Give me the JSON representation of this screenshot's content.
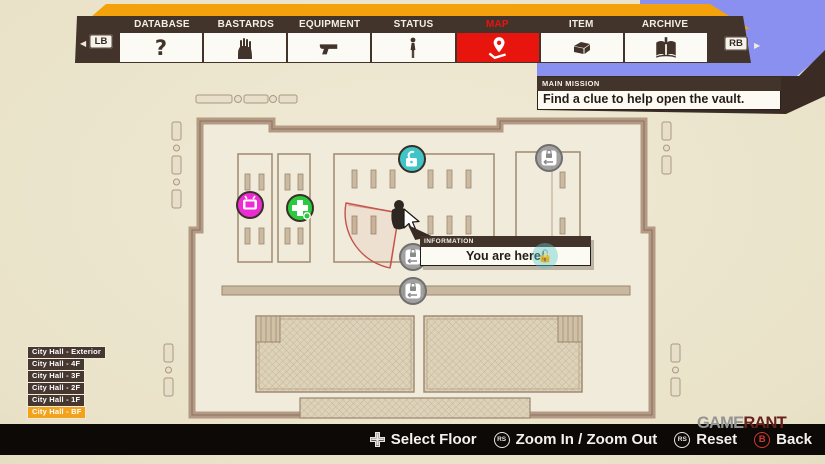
{
  "tabs": {
    "lb": "LB",
    "rb": "RB",
    "active": "MAP",
    "items": [
      {
        "label": "DATABASE",
        "icon": "question-icon"
      },
      {
        "label": "BASTARDS",
        "icon": "zombie-hand-icon"
      },
      {
        "label": "EQUIPMENT",
        "icon": "pistol-icon"
      },
      {
        "label": "STATUS",
        "icon": "person-icon"
      },
      {
        "label": "MAP",
        "icon": "map-pin-icon"
      },
      {
        "label": "ITEM",
        "icon": "item-box-icon"
      },
      {
        "label": "ARCHIVE",
        "icon": "archive-book-icon"
      }
    ]
  },
  "mission": {
    "header": "MAIN MISSION",
    "text": "Find a clue to help open the vault."
  },
  "info": {
    "header": "INFORMATION",
    "text": "You are here!"
  },
  "floors": {
    "items": [
      "City Hall - Exterior",
      "City Hall - 4F",
      "City Hall - 3F",
      "City Hall - 2F",
      "City Hall - 1F",
      "City Hall - BF"
    ],
    "selected": "City Hall - BF"
  },
  "controls": {
    "items": [
      {
        "button": "dpad",
        "btn": "",
        "label": "Select Floor"
      },
      {
        "button": "right-stick",
        "btn": "RS",
        "label": "Zoom In / Zoom Out"
      },
      {
        "button": "right-stick-press",
        "btn": "RS",
        "label": "Reset"
      },
      {
        "button": "b-button",
        "btn": "B",
        "label": "Back"
      }
    ]
  },
  "watermark": {
    "game": "GAME",
    "rant": "RANT"
  },
  "map": {
    "name": "City Hall - BF floor plan",
    "markers": [
      {
        "name": "tv-marker",
        "color": "#ee2bd3"
      },
      {
        "name": "health-marker",
        "color": "#2bc93e"
      },
      {
        "name": "unlocked-door-marker",
        "color": "#41c4c6"
      },
      {
        "name": "locked-door-marker",
        "color": "#9b9b9b"
      },
      {
        "name": "locked-door-marker",
        "color": "#9b9b9b"
      },
      {
        "name": "locked-door-marker",
        "color": "#9b9b9b"
      },
      {
        "name": "ghost-unlocked-marker",
        "color": "rgba(94,199,199,0.42)"
      }
    ],
    "player": {
      "note": "player position with red view cone and cursor"
    }
  },
  "colors": {
    "accent_orange": "#f3a20c",
    "accent_red": "#e8150f",
    "dark_brown": "#42332b",
    "periwinkle": "#8a90ef",
    "parchment": "#e9e2c8",
    "bar_black": "#0c0907"
  }
}
